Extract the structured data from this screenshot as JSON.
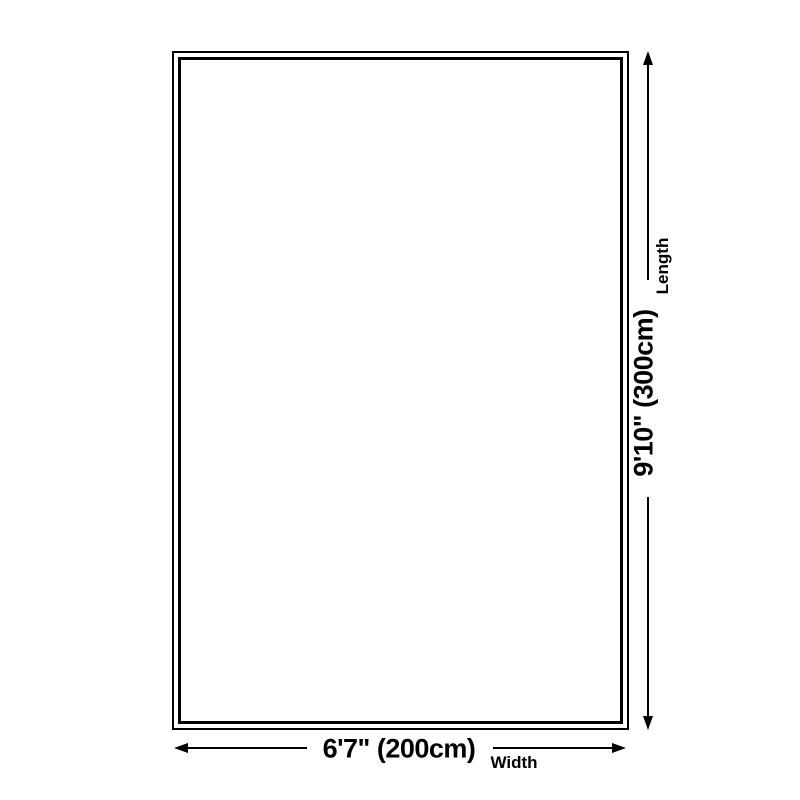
{
  "diagram": {
    "kind": "product-size-diagram",
    "background_color": "#ffffff"
  },
  "colors": {
    "line": "#000000",
    "text": "#000000"
  },
  "dimensions": {
    "width": {
      "value": "6'7\" (200cm)",
      "caption": "Width"
    },
    "length": {
      "value": "9'10\" (300cm)",
      "caption": "Length"
    }
  }
}
